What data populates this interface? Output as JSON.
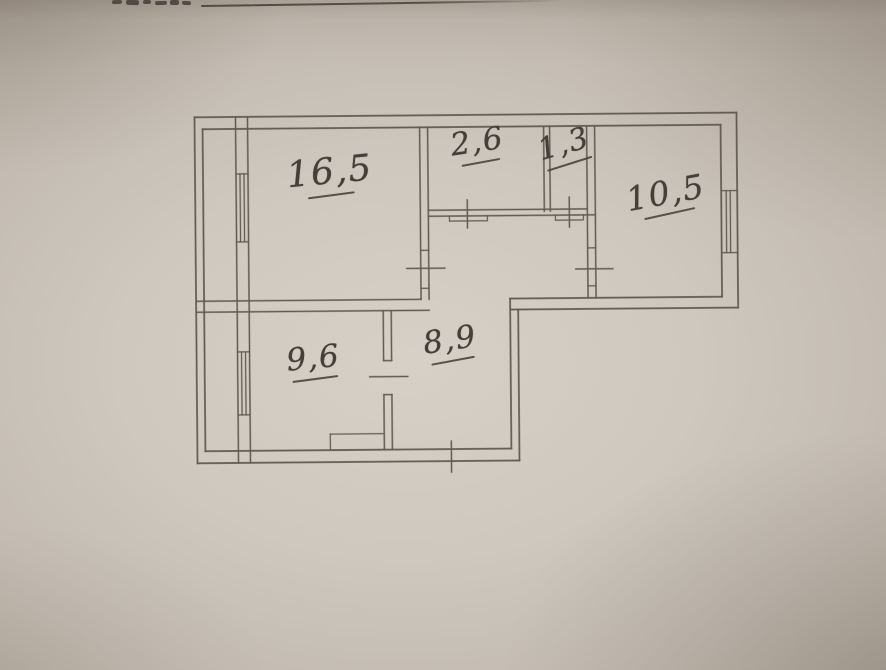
{
  "colors": {
    "paper_highlight": "#d7d0c6",
    "paper_shadow": "#a89d92",
    "plan_ink": "#5b544b",
    "handwriting_ink": "#443f38"
  },
  "floor_plan": {
    "room_labels": [
      "16,5",
      "2,6",
      "1,3",
      "10,5",
      "9,6",
      "8,9"
    ]
  },
  "artifacts": {
    "horizontal_ink_line_top": true,
    "cropped_handwriting_top_left": true
  }
}
